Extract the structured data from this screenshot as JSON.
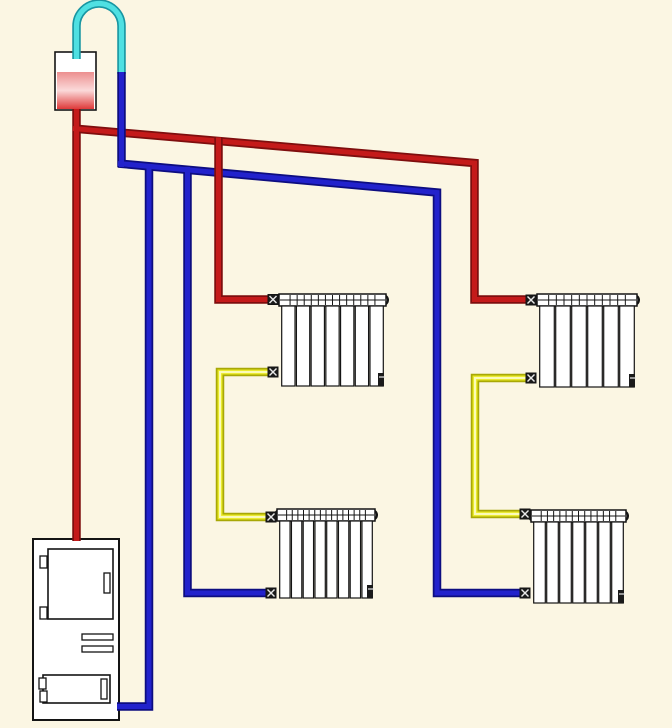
{
  "diagram": {
    "kind": "open-gravity-heating-system-schematic",
    "canvas": {
      "width": 672,
      "height": 728,
      "background": "#FBF6E3"
    },
    "palette": {
      "supply_hot": {
        "edge": "#7E0E0E",
        "main": "#C41A1A"
      },
      "return_cold": {
        "edge": "#0D0D80",
        "main": "#2222CC"
      },
      "overflow": {
        "edge": "#1896A2",
        "main": "#4FE0E2"
      },
      "interconnect": {
        "edge": "#A8A806",
        "main": "#E9E922",
        "core": "#FBFBB8"
      },
      "outline": "#141414",
      "component_fill": "#FFFFFF",
      "fitting_fill": "#1A1A1A",
      "fitting_cross": "#E8E8E8"
    },
    "expansion_tank": {
      "name": "expansion-tank",
      "x": 55,
      "y": 52,
      "width": 41,
      "height": 58,
      "liquid": {
        "x": 57,
        "y": 72,
        "width": 37,
        "height": 37,
        "gradient": [
          "#EC8F8F",
          "#FBDADA",
          "#DF3A3A"
        ]
      },
      "overflow_path": "M 76.5 59 L 76.5 26 A 22.5 22.5 0 0 1 121.5 26 L 121.5 74"
    },
    "boiler": {
      "name": "boiler",
      "x": 33,
      "y": 539,
      "width": 86,
      "height": 181,
      "upper_door": {
        "x": 48,
        "y": 549,
        "width": 65,
        "height": 70
      },
      "upper_hinges": [
        {
          "x": 40,
          "y": 556,
          "width": 7,
          "height": 12
        },
        {
          "x": 40,
          "y": 607,
          "width": 7,
          "height": 12
        }
      ],
      "upper_handle": {
        "x": 104,
        "y": 573,
        "width": 6,
        "height": 20
      },
      "vents": [
        {
          "x": 82,
          "y": 634,
          "width": 31,
          "height": 6
        },
        {
          "x": 82,
          "y": 646,
          "width": 31,
          "height": 6
        }
      ],
      "lower_door": {
        "x": 43,
        "y": 675,
        "width": 67,
        "height": 28
      },
      "lower_hinges": [
        {
          "x": 39,
          "y": 678,
          "width": 7,
          "height": 11
        },
        {
          "x": 40,
          "y": 691,
          "width": 7,
          "height": 11
        }
      ],
      "lower_handle": {
        "x": 101,
        "y": 679,
        "width": 6,
        "height": 20
      }
    },
    "radiators": [
      {
        "name": "radiator-upper-left",
        "x": 279,
        "y": 294,
        "width": 107,
        "header_h": 12,
        "body_h": 80,
        "sections": 7,
        "inlet_y": 299.5,
        "outlet_y": 372
      },
      {
        "name": "radiator-upper-right",
        "x": 537,
        "y": 294,
        "width": 100,
        "header_h": 12,
        "body_h": 81,
        "sections": 6,
        "inlet_y": 300,
        "outlet_y": 378
      },
      {
        "name": "radiator-lower-left",
        "x": 277,
        "y": 509,
        "width": 98,
        "header_h": 12,
        "body_h": 77,
        "sections": 8,
        "inlet_y": 517,
        "outlet_y": 593
      },
      {
        "name": "radiator-lower-right",
        "x": 531,
        "y": 510,
        "width": 95,
        "header_h": 12,
        "body_h": 81,
        "sections": 7,
        "inlet_y": 514,
        "outlet_y": 593
      }
    ],
    "pipe_groups": [
      {
        "group": "supply-main",
        "color": "supply_hot",
        "pipes": [
          {
            "name": "supply-riser",
            "width": 7,
            "points": [
              [
                76.5,
                109
              ],
              [
                76.5,
                541
              ]
            ]
          },
          {
            "name": "supply-header",
            "width": 7,
            "points": [
              [
                73,
                128.5
              ],
              [
                474.5,
                163
              ],
              [
                474.5,
                299.5
              ],
              [
                531,
                299.5
              ]
            ]
          }
        ]
      },
      {
        "group": "return-network",
        "color": "return_cold",
        "pipes": [
          {
            "name": "tank-return-drop",
            "width": 7,
            "points": [
              [
                121.5,
                72
              ],
              [
                121.5,
                167
              ]
            ]
          },
          {
            "name": "boiler-return",
            "width": 7,
            "points": [
              [
                149,
                164
              ],
              [
                149,
                706.5
              ],
              [
                117,
                706.5
              ]
            ]
          },
          {
            "name": "left-column-return",
            "width": 7,
            "points": [
              [
                187.5,
                167
              ],
              [
                187.5,
                593
              ],
              [
                271,
                593
              ]
            ]
          },
          {
            "name": "return-header",
            "width": 7,
            "points": [
              [
                118,
                163.5
              ],
              [
                437,
                192.5
              ],
              [
                437,
                593
              ],
              [
                524,
                593
              ]
            ]
          }
        ]
      },
      {
        "group": "supply-left-branch",
        "color": "supply_hot",
        "pipes": [
          {
            "name": "left-supply-drop",
            "width": 7,
            "points": [
              [
                218.5,
                137.5
              ],
              [
                218.5,
                299.5
              ],
              [
                271,
                299.5
              ]
            ]
          }
        ]
      },
      {
        "group": "radiator-interconnects",
        "color": "interconnect",
        "pipes": [
          {
            "name": "left-interconnect",
            "width": 7,
            "points": [
              [
                270,
                372
              ],
              [
                220,
                372
              ],
              [
                220,
                517
              ],
              [
                270,
                517
              ]
            ]
          },
          {
            "name": "right-interconnect",
            "width": 7,
            "points": [
              [
                528,
                378
              ],
              [
                475,
                378
              ],
              [
                475,
                514
              ],
              [
                523,
                514
              ]
            ]
          }
        ]
      }
    ]
  }
}
